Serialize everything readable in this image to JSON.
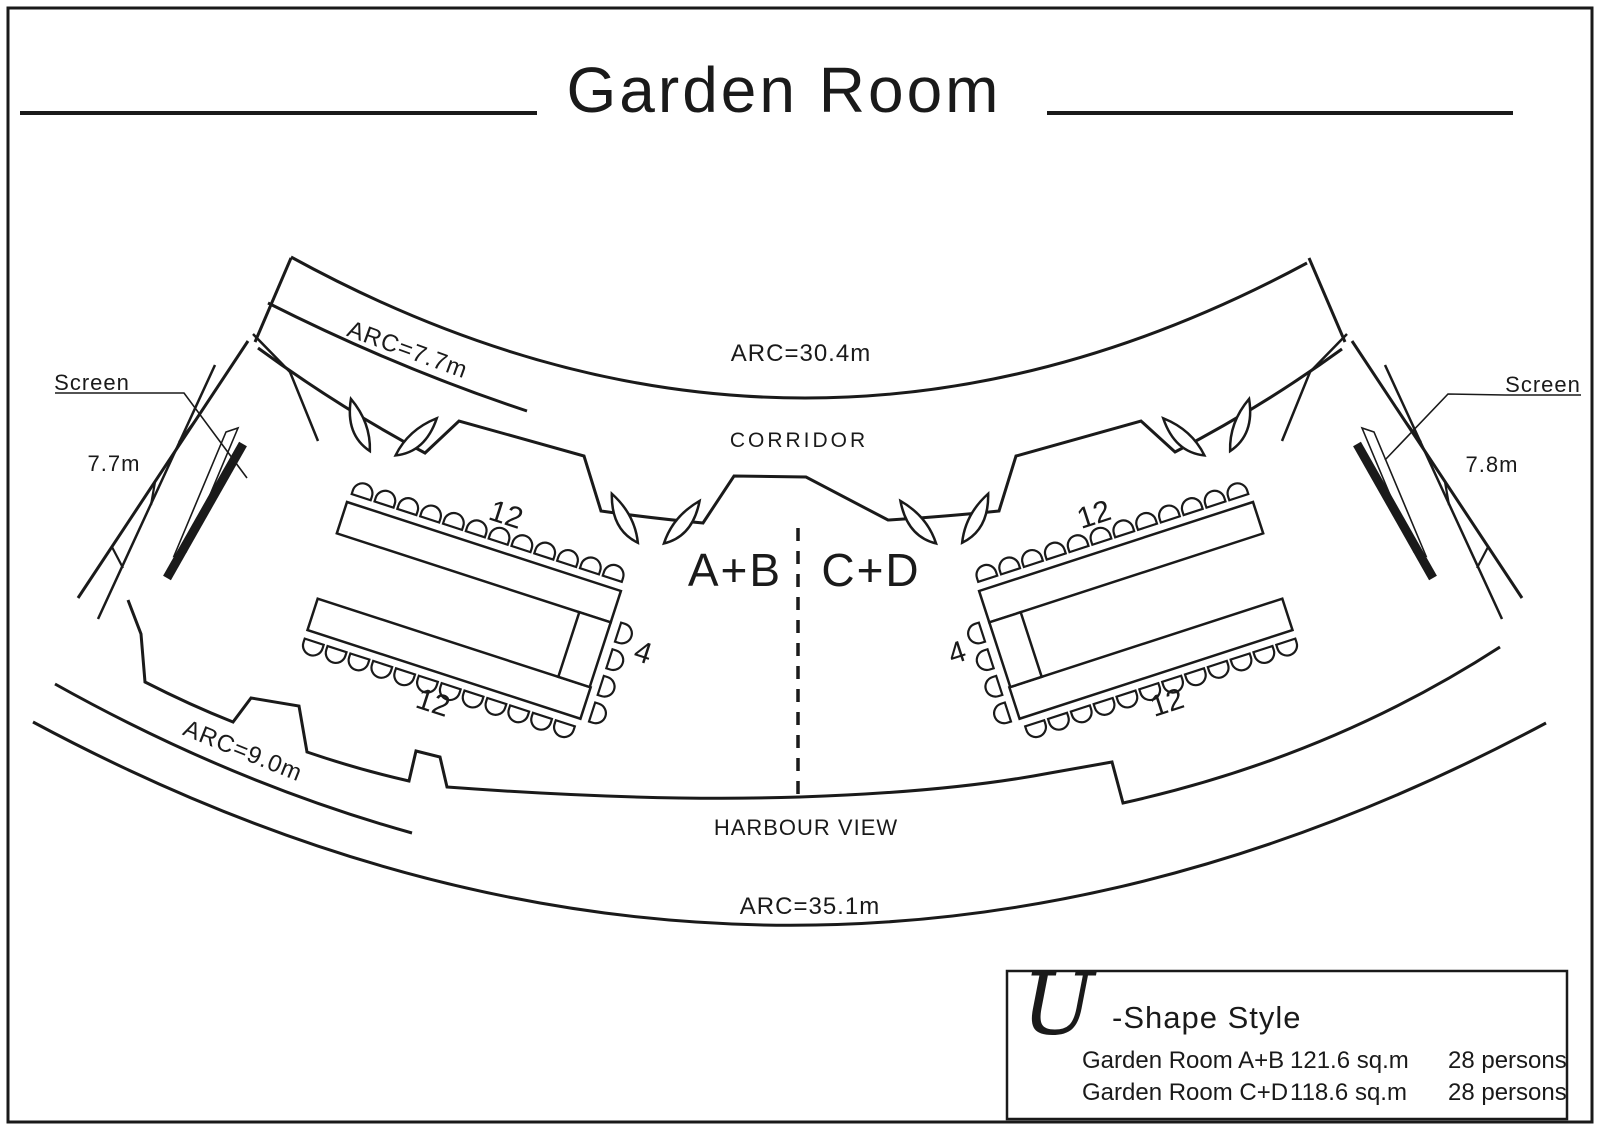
{
  "title": {
    "text": "Garden Room"
  },
  "plan": {
    "arc_top_outer": "ARC=30.4m",
    "arc_top_left": "ARC=7.7m",
    "arc_bottom_left": "ARC=9.0m",
    "arc_bottom_outer": "ARC=35.1m",
    "corridor": "CORRIDOR",
    "harbour_view": "HARBOUR VIEW",
    "room_left": "A+B",
    "room_right": "C+D",
    "screen_left": "Screen",
    "screen_right": "Screen",
    "dim_left": "7.7m",
    "dim_right": "7.8m",
    "seats_left": {
      "top": "12",
      "bottom": "12",
      "side": "4"
    },
    "seats_right": {
      "top": "12",
      "bottom": "12",
      "side": "4"
    }
  },
  "legend": {
    "style_initial": "U",
    "style_name": "-Shape Style",
    "rows": [
      {
        "name": "Garden Room A+B",
        "area": "121.6 sq.m",
        "capacity": "28 persons"
      },
      {
        "name": "Garden Room C+D",
        "area": "118.6 sq.m",
        "capacity": "28 persons"
      }
    ]
  },
  "colors": {
    "ink": "#1a1a1a",
    "paper": "#ffffff"
  }
}
